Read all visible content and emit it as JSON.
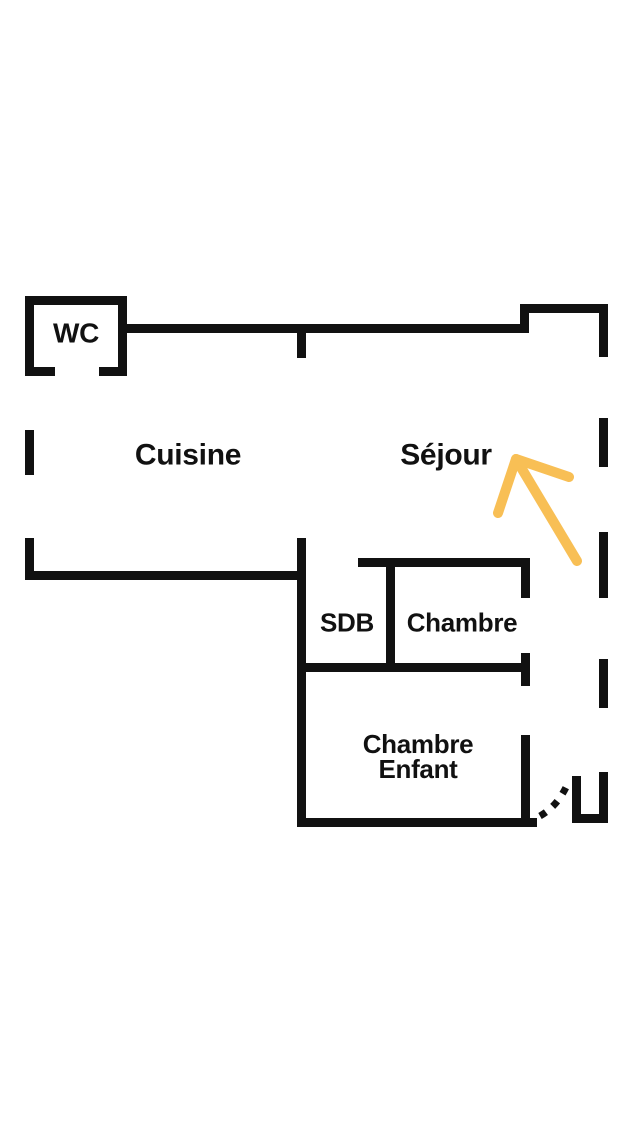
{
  "floorplan": {
    "kind": "apartment floor plan sketch",
    "rooms": {
      "wc": {
        "label": "WC"
      },
      "cuisine": {
        "label": "Cuisine"
      },
      "sejour": {
        "label": "Séjour"
      },
      "sdb": {
        "label": "SDB"
      },
      "chambre": {
        "label": "Chambre"
      },
      "chambre_enfant": {
        "label_line1": "Chambre",
        "label_line2": "Enfant"
      }
    },
    "annotation_arrow": {
      "shape": "hand-drawn arrow",
      "direction": "up-left",
      "points_at": "Séjour",
      "color": "#F8BF55"
    },
    "door_swing": {
      "style": "dotted arc",
      "location": "bottom-right entrance"
    }
  },
  "colors": {
    "background": "#FFFFFF",
    "wall": "#111111",
    "label_text": "#111111",
    "arrow": "#F8BF55"
  }
}
